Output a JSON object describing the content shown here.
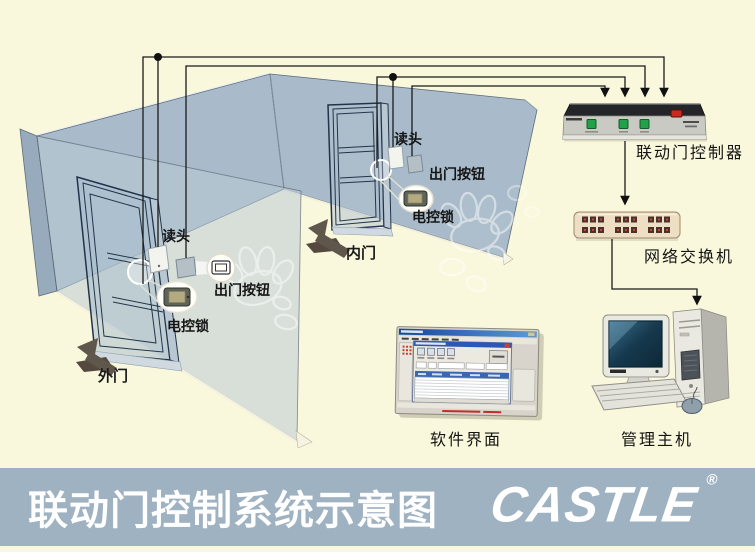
{
  "footer": {
    "title": "联动门控制系统示意图",
    "logo": "CASTLE",
    "registered": "®"
  },
  "doors": {
    "outer": {
      "label": "外门",
      "reader": "读头",
      "exit_button": "出门按钮",
      "lock": "电控锁"
    },
    "inner": {
      "label": "内门",
      "reader": "读头",
      "exit_button": "出门按钮",
      "lock": "电控锁"
    }
  },
  "devices": {
    "controller": {
      "label": "联动门控制器"
    },
    "network_switch": {
      "label": "网络交换机"
    },
    "software": {
      "label": "软件界面"
    },
    "host": {
      "label": "管理主机"
    }
  },
  "colors": {
    "background": "#faf8dc",
    "footer_bar": "#9fb2c2",
    "wall": "#a9bbca",
    "wall_translucent": "rgba(186,202,213,0.55)",
    "wire": "#1a1a1a",
    "controller_button_green": "#22a04a",
    "controller_indicator_red": "#cc2a1e",
    "switch_body": "#eedec4",
    "label_text": "#151515",
    "footer_text": "#ffffff"
  }
}
